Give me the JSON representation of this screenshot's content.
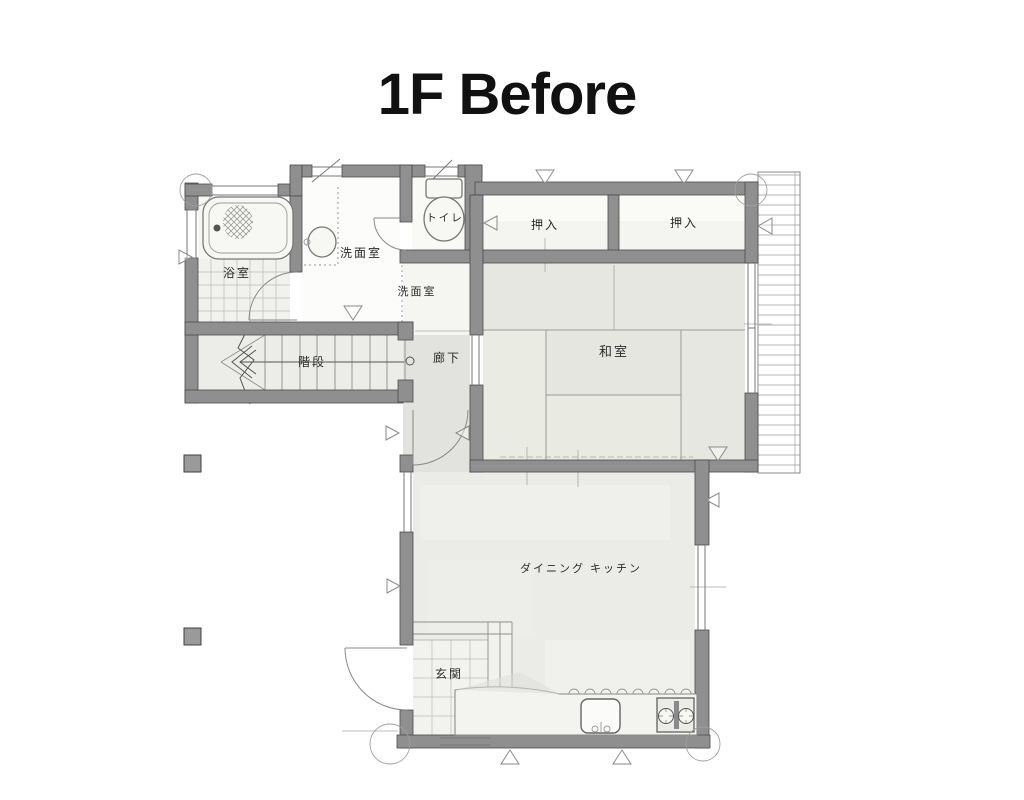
{
  "title": "1F Before",
  "rooms": {
    "bathroom": {
      "label": "浴室"
    },
    "washroom": {
      "label": "洗面室"
    },
    "washroom_annex": {
      "label": "洗面室"
    },
    "toilet": {
      "label": "トイレ"
    },
    "closet_left": {
      "label": "押入"
    },
    "closet_right": {
      "label": "押入"
    },
    "japanese_room": {
      "label": "和室"
    },
    "stairs": {
      "label": "階段"
    },
    "hallway": {
      "label": "廊下"
    },
    "dining_kitchen": {
      "label": "ダイニング キッチン"
    },
    "entrance": {
      "label": "玄関"
    }
  },
  "colors": {
    "background": "#ffffff",
    "wall": "#8f8f8f",
    "wall_edge": "#4a4a4a",
    "tatami": "#e8e9e2",
    "floor": "#ebebe8",
    "corridor": "#e2e3de",
    "tile": "#f1f1ed",
    "line": "#777777",
    "title_text": "#111111"
  }
}
